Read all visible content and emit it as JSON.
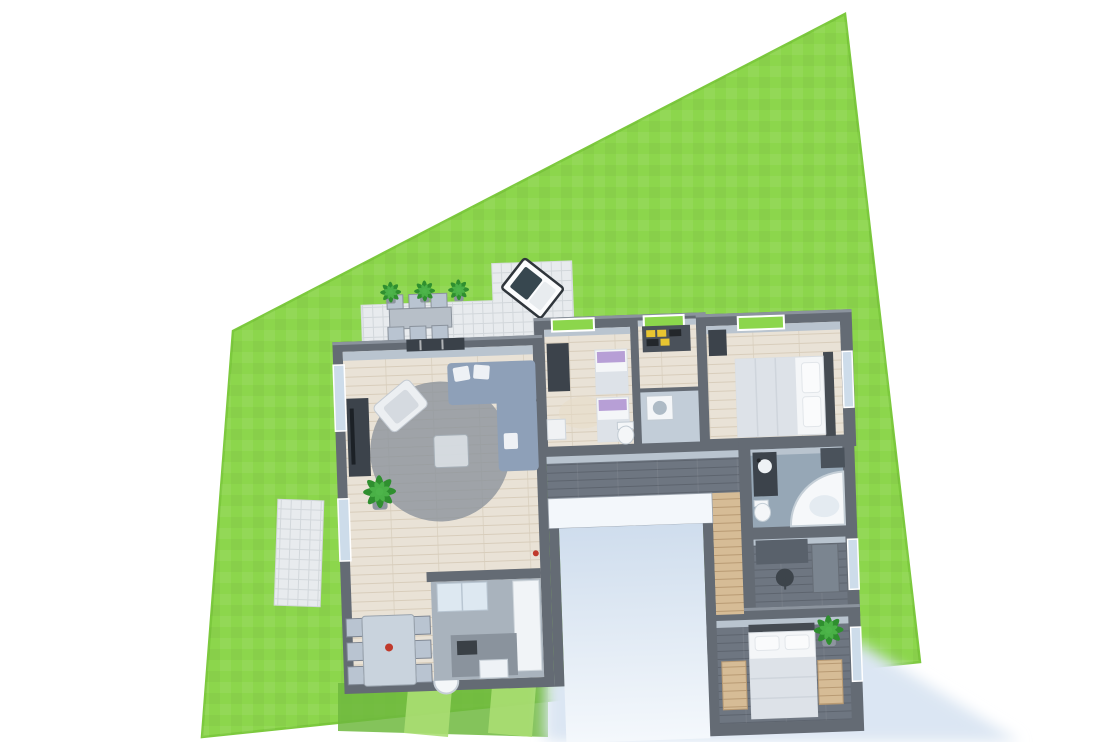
{
  "scene": {
    "description": "3D rendered top-down floor plan of a single-story house with furnished rooms, placed on a bright green lawn plot with a paved terrace, entry courtyard and soft cast shadow",
    "canvas": {
      "width": 1117,
      "height": 742
    }
  },
  "colors": {
    "bg": "#ffffff",
    "lawn": "#8cd64c",
    "lawnEdge": "#7cc93d",
    "lawnShade": "#6fb93e",
    "lawnStripe": "#aade72",
    "wall": "#646b74",
    "wallTop": "#8b939d",
    "wallInner": "#b9c4cf",
    "woodFloor": "#e9e2d6",
    "woodPlank": "#d8cdbb",
    "darkFloor": "#6e7681",
    "darkFloorLine": "#5d646e",
    "tileFloor": "#96a7b6",
    "tileLight": "#c2cdd8",
    "kitchenFloor": "#a9b3bd",
    "paving": "#e8ebee",
    "pavingLine": "#d2d7db",
    "shadow": "#dbe6f3",
    "courtyardTop": "#cfdded",
    "courtyardBottom": "#f4f8fc",
    "hallWallWhite": "#f3f7fb",
    "sofa": "#8ea0b8",
    "rug": "#8c939c",
    "whiteFurn": "#f4f6f8",
    "blanket": "#dde2e8",
    "purple": "#b79fd6",
    "tan": "#d6bc96",
    "plantDark": "#2f8f2f",
    "plantLight": "#4db54a",
    "glass": "#cddcea",
    "glassGreen": "#8cd64c",
    "chair": "#b9c4d1",
    "tableTop": "#c9d3dd",
    "counterDark": "#5b626b",
    "island": "#8a939d",
    "appliance": "#eef2f6",
    "fridge": "#dde8f1",
    "furnitureDark": "#3c434b",
    "accentRed": "#c0392b",
    "loungeCushion": "#37474f",
    "headboard": "#454b52"
  },
  "plot": {
    "shape": "quadrilateral lawn parcel",
    "points": "233,331 845,14 920,662 202,737"
  },
  "ground": {
    "shade_points": "338,683 548,681 548,737 338,731",
    "stripe1_points": "408,688 452,688 448,737 404,733",
    "stripe2_points": "492,686 536,686 532,737 488,733"
  },
  "shadow": {
    "points": "545,676 862,644 1020,742 545,742"
  },
  "terrace": {
    "points": "368,297 500,297 500,260 580,260 580,333 368,333"
  },
  "garden_path": {
    "transform": "rotate(2 299 553)"
  },
  "house": {
    "transform": "rotate(-2 600 500)",
    "rooms": [
      {
        "id": "living-dining-room",
        "floor": "light wood"
      },
      {
        "id": "kitchen",
        "floor": "grey"
      },
      {
        "id": "kids-bedroom",
        "floor": "light wood"
      },
      {
        "id": "storage-room",
        "floor": "light wood"
      },
      {
        "id": "laundry-wc",
        "floor": "light tile"
      },
      {
        "id": "master-bedroom",
        "floor": "light wood"
      },
      {
        "id": "hallway",
        "floor": "dark plank"
      },
      {
        "id": "corridor",
        "floor": "tan wood"
      },
      {
        "id": "bathroom",
        "floor": "blue-grey tile"
      },
      {
        "id": "office",
        "floor": "dark plank"
      },
      {
        "id": "bedroom-2",
        "floor": "dark plank"
      },
      {
        "id": "courtyard",
        "floor": "concrete"
      }
    ],
    "furniture": [
      "corner-sofa",
      "armchair",
      "tv-cabinet",
      "area-rug",
      "coffee-table",
      "dining-table-6-chairs",
      "bar-stools",
      "kitchen-island",
      "fridge",
      "kitchen-counter",
      "dishwasher",
      "kids-beds-purple-pillows",
      "wardrobe",
      "shelf-unit",
      "washing-machine",
      "toilet",
      "double-bed",
      "vanity",
      "corner-bathtub",
      "desk",
      "office-chair",
      "cabinet",
      "bed",
      "nightstands",
      "houseplants",
      "outdoor-dining-set",
      "outdoor-lounge",
      "terrace-potted-plants"
    ]
  }
}
